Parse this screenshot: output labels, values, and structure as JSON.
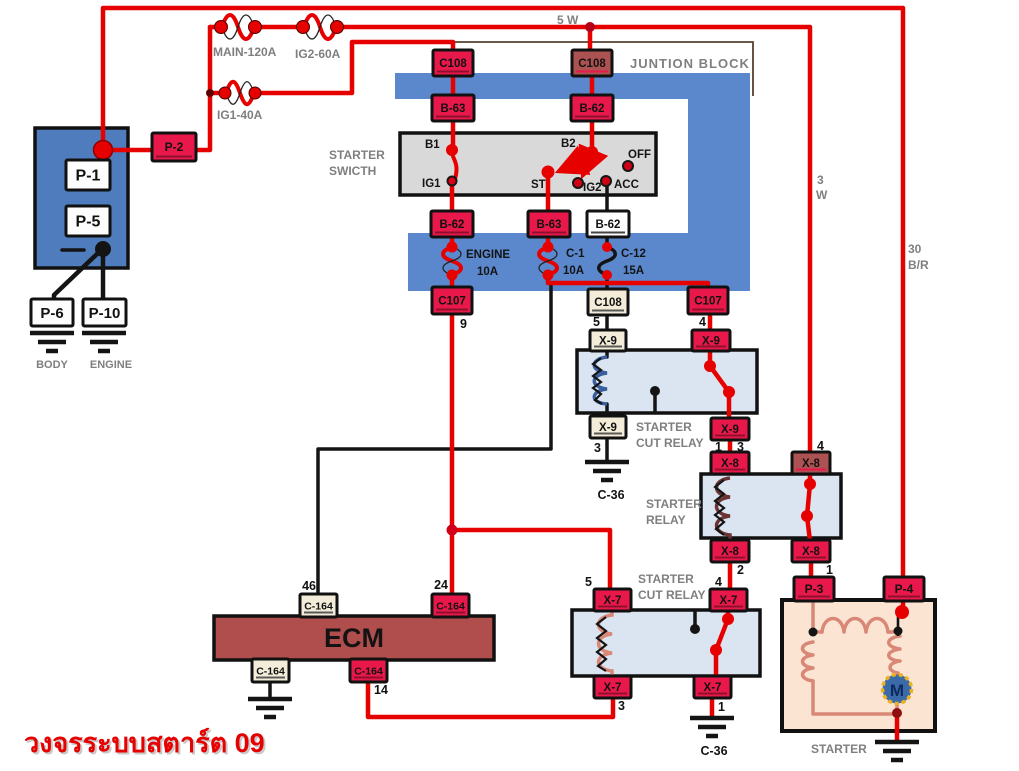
{
  "title": {
    "caption": "วงจรระบบสตาร์ต 09"
  },
  "sections": {
    "junction_block": "JUNTION BLOCK",
    "starter_switch1": "STARTER",
    "starter_switch2": "SWICTH",
    "cut_relay1a": "STARTER",
    "cut_relay1b": "CUT  RELAY",
    "relay_a": "STARTER",
    "relay_b": "RELAY",
    "cut_relay2a": "STARTER",
    "cut_relay2b": "CUT  RELAY",
    "starter_unit": "STARTER"
  },
  "labels": {
    "ecm": "ECM",
    "motor": "M",
    "body": "BODY",
    "engine": "ENGINE"
  },
  "fuses": {
    "main": "MAIN-120A",
    "ig2": "IG2-60A",
    "ig1": "IG1-40A",
    "eng_a": "ENGINE",
    "eng_b": "10A",
    "c1a": "C-1",
    "c1b": "10A",
    "c12a": "C-12",
    "c12b": "15A"
  },
  "wires": {
    "w5": "5 W",
    "w3a": "3",
    "w3b": "W",
    "br30a": "30",
    "br30b": "B/R"
  },
  "switch": {
    "b1": "B1",
    "ig1": "IG1",
    "b2": "B2",
    "st": "ST",
    "ig2": "IG2",
    "acc": "ACC",
    "off": "OFF"
  },
  "connectors": {
    "p1": "P-1",
    "p2": "P-2",
    "p5": "P-5",
    "p6": "P-6",
    "p10": "P-10",
    "c108_ig1": "C108",
    "b63_ig1": "B-63",
    "b62_ig1": "B-62",
    "c108_b2": "C108",
    "b62_b2": "B-62",
    "b63_st": "B-63",
    "b62_acc": "B-62",
    "c107_eng": "C107",
    "c108_acc": "C108",
    "c107_st": "C107",
    "x9_tl": "X-9",
    "x9_tr": "X-9",
    "x9_bl": "X-9",
    "x9_br": "X-9",
    "x8_tl": "X-8",
    "x8_tr": "X-8",
    "x8_bl": "X-8",
    "x8_br": "X-8",
    "x7_tl": "X-7",
    "x7_tr": "X-7",
    "x7_bl": "X-7",
    "x7_br": "X-7",
    "c164_46": "C-164",
    "c164_24": "C-164",
    "c164_gnd": "C-164",
    "c164_14": "C-164",
    "p3": "P-3",
    "p4": "P-4"
  },
  "pins": {
    "eng9": "9",
    "acc5": "5",
    "st4": "4",
    "x9_3": "3",
    "x9_1": "1",
    "x8_3": "3",
    "x8_4": "4",
    "x8_2": "2",
    "x8_1": "1",
    "x7_5": "5",
    "x7_4": "4",
    "x7_3": "3",
    "x7_1": "1",
    "ecm46": "46",
    "ecm24": "24",
    "ecm14": "14"
  },
  "grounds": {
    "c36_a": "C-36",
    "c36_b": "C-36"
  },
  "colors": {
    "wire_red": "#e60000",
    "box_crimson": "#e8194a",
    "box_muted": "#ad5252",
    "box_cream": "#f2ecd8",
    "junction_blue": "#5b88cc",
    "battery_blue": "#4f7cbc",
    "relay_fill": "#dbe5f1",
    "switch_fill": "#d9d9d9",
    "starter_fill": "#fbe5d2",
    "ecm_fill": "#b04e4e",
    "coil_blue": "#3a5f9e",
    "coil_brown": "#6b3434",
    "coil_salmon": "#d98878",
    "label_grey": "#7f7f7f",
    "title_red": "#e60000",
    "motor_blue": "#3a6ba8",
    "motor_ring": "#edb31f"
  }
}
